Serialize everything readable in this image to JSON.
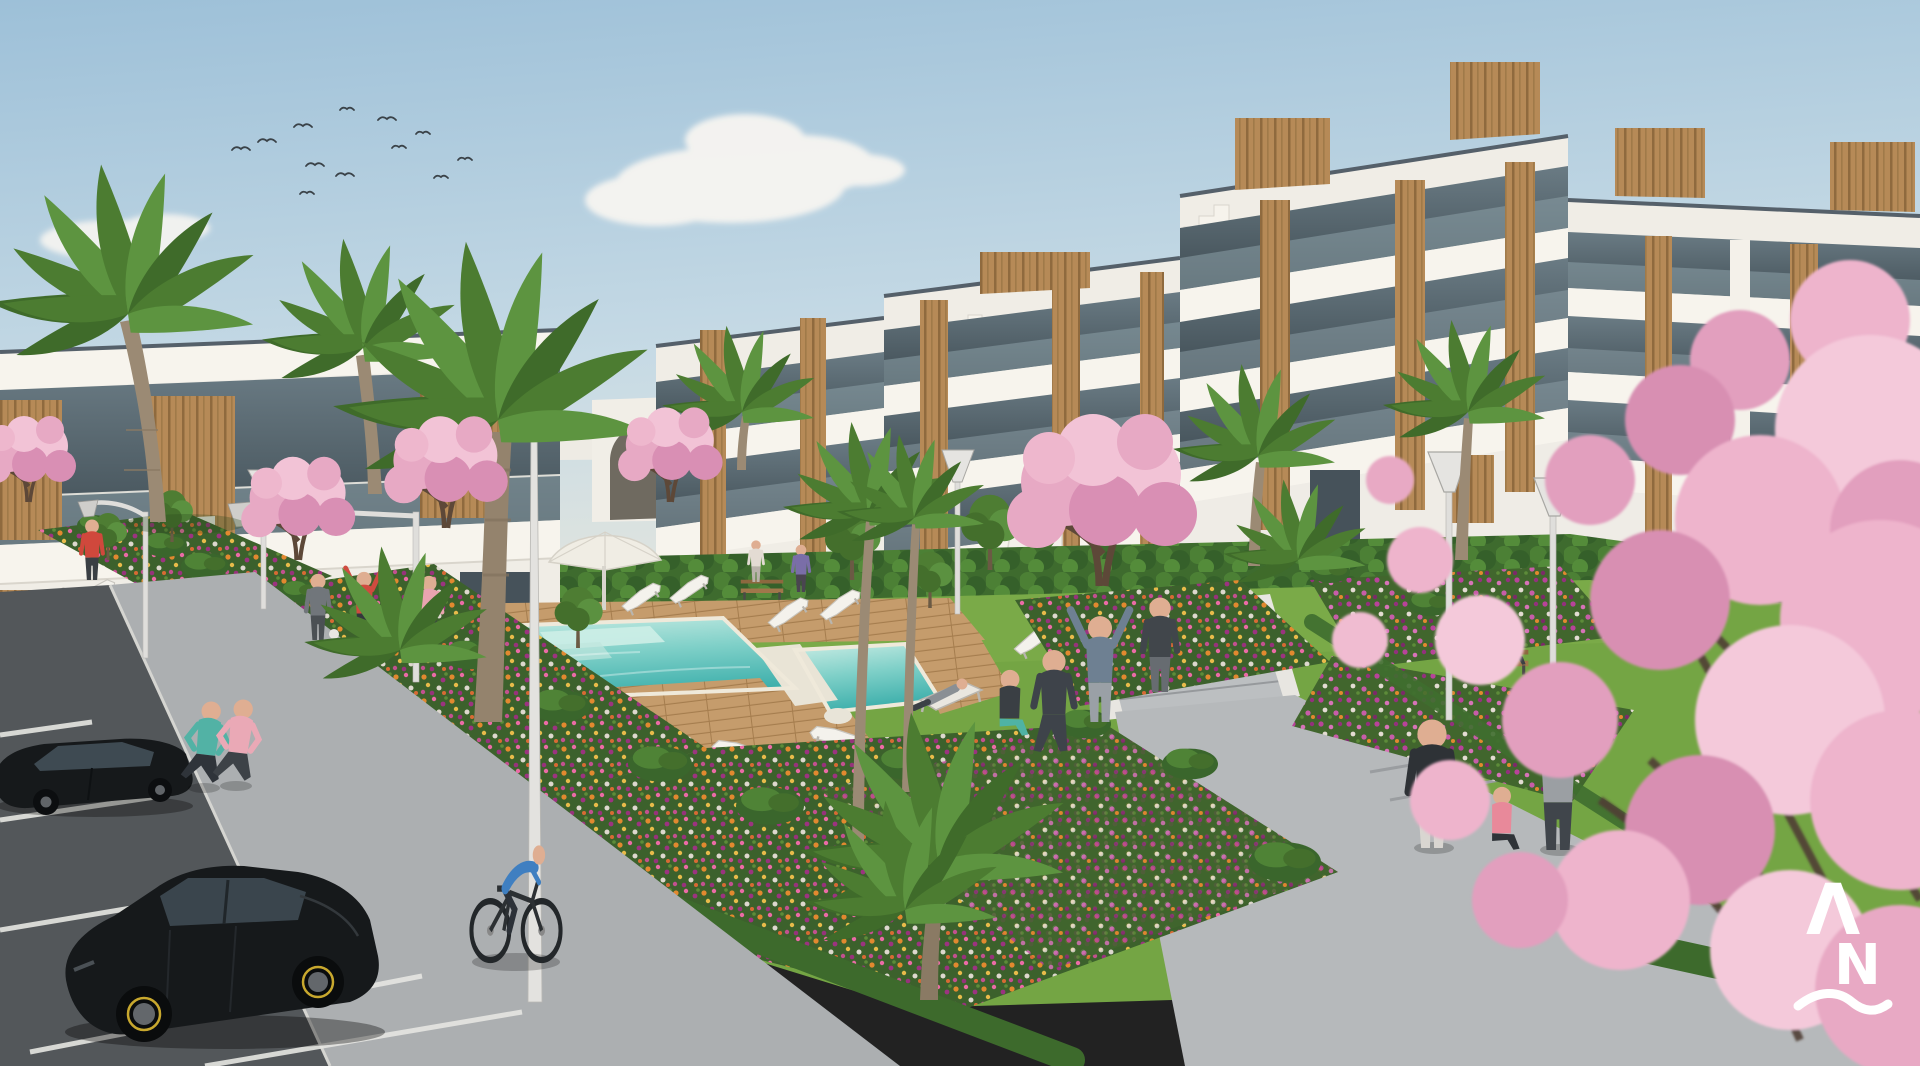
{
  "image": {
    "kind": "3d-architectural-exterior-rendering",
    "subject": "modern white apartment complex with communal garden, swimming pool, flower beds and parking",
    "width_px": 1920,
    "height_px": 1066
  },
  "watermark": {
    "letter_top": "Λ",
    "letter_bottom": "N",
    "underline": "wave-stroke",
    "color": "#ffffff"
  },
  "palette": {
    "sky_top": "#9dc0d8",
    "sky_mid": "#c6dae5",
    "sky_horizon": "#ece9dc",
    "cloud": "#f7f5f1",
    "building_white": "#f0ede6",
    "fascia_white": "#f7f4ed",
    "wall_shadow": "#d9d5cc",
    "coping_dark": "#55606a",
    "glass_dark": "#46525a",
    "glass_balustrade": "#8da0a8",
    "wood_light": "#b68a57",
    "wood_dark": "#8f6a3e",
    "grass": "#74a544",
    "grass_dark": "#619339",
    "hedge": "#3e6b2e",
    "deck_wood": "#c59c6c",
    "deck_line": "#a57d4e",
    "pool_shallow": "#c9ece4",
    "pool_deep": "#3fb0ac",
    "pool_coping": "#efe9da",
    "path": "#b6b9bb",
    "sidewalk": "#acafb1",
    "asphalt": "#53575a",
    "stall_line": "#e6e6e2",
    "flower_orange": "#e2892f",
    "flower_pink": "#eb6ba6",
    "flower_magenta": "#9c3380",
    "blossom": "#e7a9c4",
    "blossom_light": "#f2c3d6",
    "blossom_deep": "#d98fb4",
    "branch": "#503f34",
    "palm_green": "#4c7c31",
    "trunk": "#9b8a74",
    "car_paint": "#16191b",
    "car_glass": "#3a454d",
    "rim_accent": "#c8a82e",
    "skin": "#dfae92",
    "watermark": "#ffffff"
  },
  "scene": {
    "sky": {
      "description": "clear pale blue sky with scattered soft clouds and a flock of birds",
      "bird_count": 12,
      "cloud_count": 4
    },
    "buildings": [
      {
        "name": "left-terraced-block",
        "floors": 2,
        "features": [
          "glass balustrade terraces",
          "timber cladding panels",
          "external white staircase"
        ]
      },
      {
        "name": "main-apartment-block",
        "floors": 3,
        "features": [
          "stepped white parapets",
          "rooftop timber volumes",
          "glass balconies",
          "timber cladding columns",
          "stair-step parapet motif"
        ]
      },
      {
        "name": "right-apartment-block",
        "floors": 3,
        "features": [
          "rooftop timber volumes",
          "glass balconies",
          "timber cladding columns"
        ]
      },
      {
        "name": "garden-arch-wall",
        "features": [
          "arched opening"
        ]
      }
    ],
    "pool": {
      "water": "turquoise",
      "deck": "timber planks",
      "sections": [
        "main lap pool",
        "side spa section"
      ],
      "steps": true,
      "parasol": true
    },
    "vegetation": {
      "palm_trees": 9,
      "cherry_blossom_trees": 6,
      "green_trees": 7,
      "bushes": 16,
      "flower_beds": 6,
      "flower_colors": [
        "orange",
        "pink",
        "magenta",
        "white"
      ],
      "hedges": true,
      "lawn": true
    },
    "people": {
      "count": 19,
      "activities": [
        "jogging",
        "cycling",
        "stretching",
        "yoga",
        "walking",
        "sitting on bench",
        "reclining on deck chair",
        "standing"
      ]
    },
    "vehicles": [
      {
        "type": "sedan",
        "color": "black"
      },
      {
        "type": "hatchback",
        "color": "black",
        "wheel_accent": "yellow"
      }
    ],
    "furniture": {
      "sun_loungers": 12,
      "deck_chairs": 2,
      "benches": 3,
      "street_lamps": 7,
      "parasols": 1
    },
    "parking": {
      "stall_lines": 5,
      "surface": "asphalt"
    }
  }
}
